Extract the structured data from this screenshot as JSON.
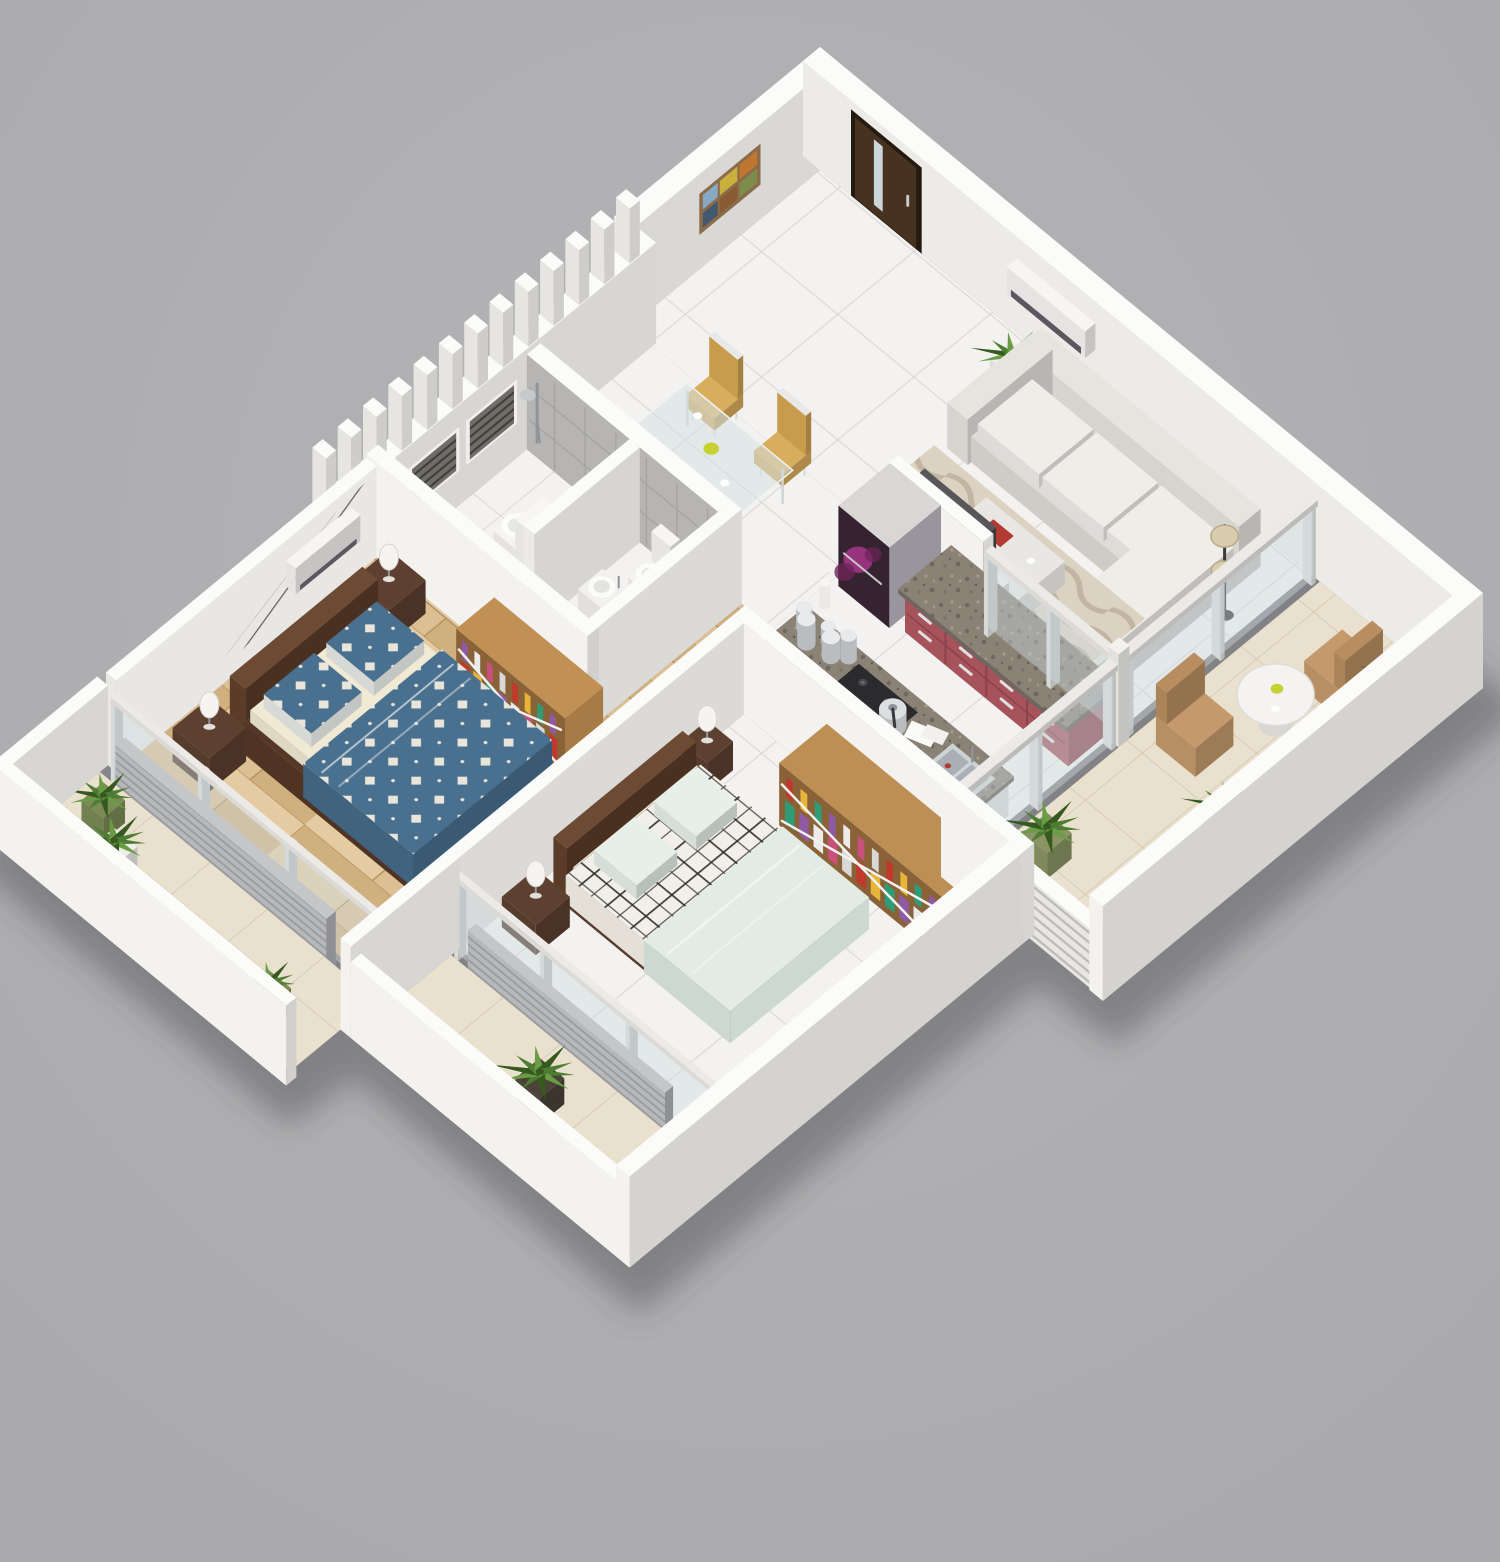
{
  "scene": {
    "title": "3D isometric render of a two-bedroom apartment floor plan",
    "background": "#a9a9ab",
    "rooms": [
      {
        "id": "entrance",
        "label": "Entrance",
        "floor": "white-tile",
        "furniture": [
          "wooden-entry-door"
        ]
      },
      {
        "id": "living-room",
        "label": "Living room",
        "floor": "white-tile",
        "furniture": [
          "l-shaped-sofa",
          "area-rug",
          "coffee-table",
          "floor-lamp",
          "tv-unit",
          "tv",
          "potted-plant",
          "air-conditioner"
        ]
      },
      {
        "id": "dining-area",
        "label": "Dining area",
        "floor": "white-tile",
        "furniture": [
          "glass-dining-table",
          "dining-chair",
          "dining-chair",
          "dining-chair",
          "dining-chair",
          "fruit-bowl"
        ]
      },
      {
        "id": "kitchen",
        "label": "Kitchen",
        "floor": "white-tile",
        "furniture": [
          "refrigerator",
          "maroon-cabinet-run",
          "granite-countertop",
          "island-counter",
          "gas-hob",
          "double-bowl-sink",
          "pressure-cooker",
          "cutting-boards",
          "storage-jars",
          "flower-vase"
        ]
      },
      {
        "id": "bathroom",
        "label": "Bathroom",
        "floor": "white-tile",
        "furniture": [
          "shower-set",
          "toilet",
          "bidet",
          "vessel-basin",
          "pedestal-basin",
          "louvered-window",
          "louvered-window",
          "divider-wall"
        ]
      },
      {
        "id": "corridor",
        "label": "Corridor",
        "floor": "wood-plank",
        "furniture": [
          "doormat"
        ]
      },
      {
        "id": "master-bedroom",
        "label": "Master bedroom",
        "floor": "wood-plank",
        "furniture": [
          "double-bed",
          "blue-checkered-bedding",
          "nightstand",
          "nightstand",
          "table-lamp",
          "table-lamp",
          "sideboard-with-accessories",
          "abstract-wall-mural",
          "air-conditioner"
        ]
      },
      {
        "id": "bedroom-2",
        "label": "Bedroom 2",
        "floor": "white-tile",
        "furniture": [
          "double-bed",
          "plaid-bedding",
          "mint-duvet",
          "wardrobe-with-accessories",
          "nightstand",
          "nightstand",
          "table-lamp",
          "table-lamp"
        ]
      },
      {
        "id": "living-balcony",
        "label": "Living room balcony",
        "floor": "beige-tile",
        "furniture": [
          "rattan-armchair",
          "rattan-armchair",
          "patio-table",
          "potted-plant",
          "potted-plant",
          "potted-plant",
          "slatted-railing",
          "glass-partition"
        ]
      },
      {
        "id": "master-bedroom-balcony",
        "label": "Master bedroom balcony",
        "floor": "beige-tile",
        "furniture": [
          "potted-plant",
          "potted-plant",
          "potted-plant",
          "roller-shutter",
          "glass-partition"
        ]
      },
      {
        "id": "bedroom-2-balcony",
        "label": "Bedroom 2 balcony",
        "floor": "beige-tile",
        "furniture": [
          "potted-plant",
          "roller-shutter",
          "glass-partition"
        ]
      }
    ],
    "structure": [
      "perimeter-walls",
      "vertical-fin-wall",
      "gray-tiled-bath-wall",
      "wall-art-six-tiles"
    ],
    "palette": {
      "bg": "#a9a9ab",
      "bgLight": "#b4b4b6",
      "shadow": "rgba(66,66,70,0.4)",
      "wallTop": "#fbfbfa",
      "wallIn": "#edebe7",
      "wallWhite": "#f3f2ef",
      "wallSide": "#d6d4d0",
      "wallDark": "#c9c7c3",
      "tile": "#f3f2f0",
      "grout": "#dad8d5",
      "balcTile": "#e9e1ce",
      "balcGrout": "#d3c8b1",
      "wood": "#dcbf92",
      "wood2": "#d0b07f",
      "wood3": "#e5cba2",
      "woodGap": "#b3905f",
      "grayTile": "#b6b5b3",
      "grayTileLine": "#a4a3a1",
      "grayTileDark": "#a8a7a5",
      "granite": "#8b8276",
      "graniteDark": "#6e675d",
      "graniteLight": "#a59c8e",
      "maroon": "#a7535c",
      "maroonDark": "#8a424c",
      "fridgeFront": "#35232f",
      "fridgeSide": "#98969c",
      "bloom": "#a8368a",
      "bloom2": "#6e2458",
      "sofa": "#e6e4df",
      "cushion": "#efede8",
      "rug": "#dcd2c2",
      "rugLine": "#b9aa95",
      "glass": "rgba(206,219,223,0.42)",
      "glassFrame": "#e9e9e7",
      "green1": "#4d7c33",
      "green2": "#699c45",
      "green3": "#36591f",
      "potWhite": "#efeeec",
      "potGreen": "#7a8b56",
      "potDark": "#4a4438",
      "potOlive": "#8a9363",
      "chairWood": "#d8ad5b",
      "chairWood2": "#c89c4d",
      "chairFrame": "#e8e8e8",
      "glassTable": "rgba(213,226,228,0.55)",
      "bedBrown": "#5a3c29",
      "bedBrown2": "#6d4a33",
      "bedDark": "#4a3020",
      "mattress": "#f0e9d3",
      "blue": "#49708f",
      "blueDark": "#3a5a74",
      "blueDrape": "#40637f",
      "checkWhite": "#e9e5da",
      "plaidBase": "#f2efe8",
      "plaidLine": "#2a2a2a",
      "mint": "#e2ebe5",
      "mintShade": "#ccd8d1",
      "steel": "#c6cacd",
      "steelDark": "#8f949a",
      "doorBrown": "#46321f",
      "doorDark": "#241a10",
      "doorGlass": "#ccd6da",
      "acBody": "#f6f5f3",
      "acVent": "#5a5760",
      "lamp": "#f6f4f1",
      "shutter": "#b7b8ba",
      "shutterLine": "#989a9d",
      "hob": "#2b2b2d",
      "sinkSteel": "#cdd2d5",
      "sinkIn": "#a9afb4",
      "mural1": "#8b8984",
      "mural2": "#6f6d68",
      "mural3": "#a3a19c",
      "muralBase": "#e9e7e3",
      "mat": "#d7c3bb",
      "artFrame": "#8a6b4a",
      "art": [
        "#c0762f",
        "#c9b03c",
        "#87a9c4",
        "#7d8c4b",
        "#8a5b33",
        "#44586e"
      ],
      "items": [
        "#c0392b",
        "#e8b53a",
        "#2e9d77",
        "#8e5aa5",
        "#ecebe9",
        "#c94f7c",
        "#d8d8d8"
      ],
      "fruit": "#c6d234",
      "railBg": "#e8e7e4",
      "railSlat": "#bdbcb9",
      "louvBg": "#6e6d68",
      "louvLine": "#3e3d39"
    }
  }
}
